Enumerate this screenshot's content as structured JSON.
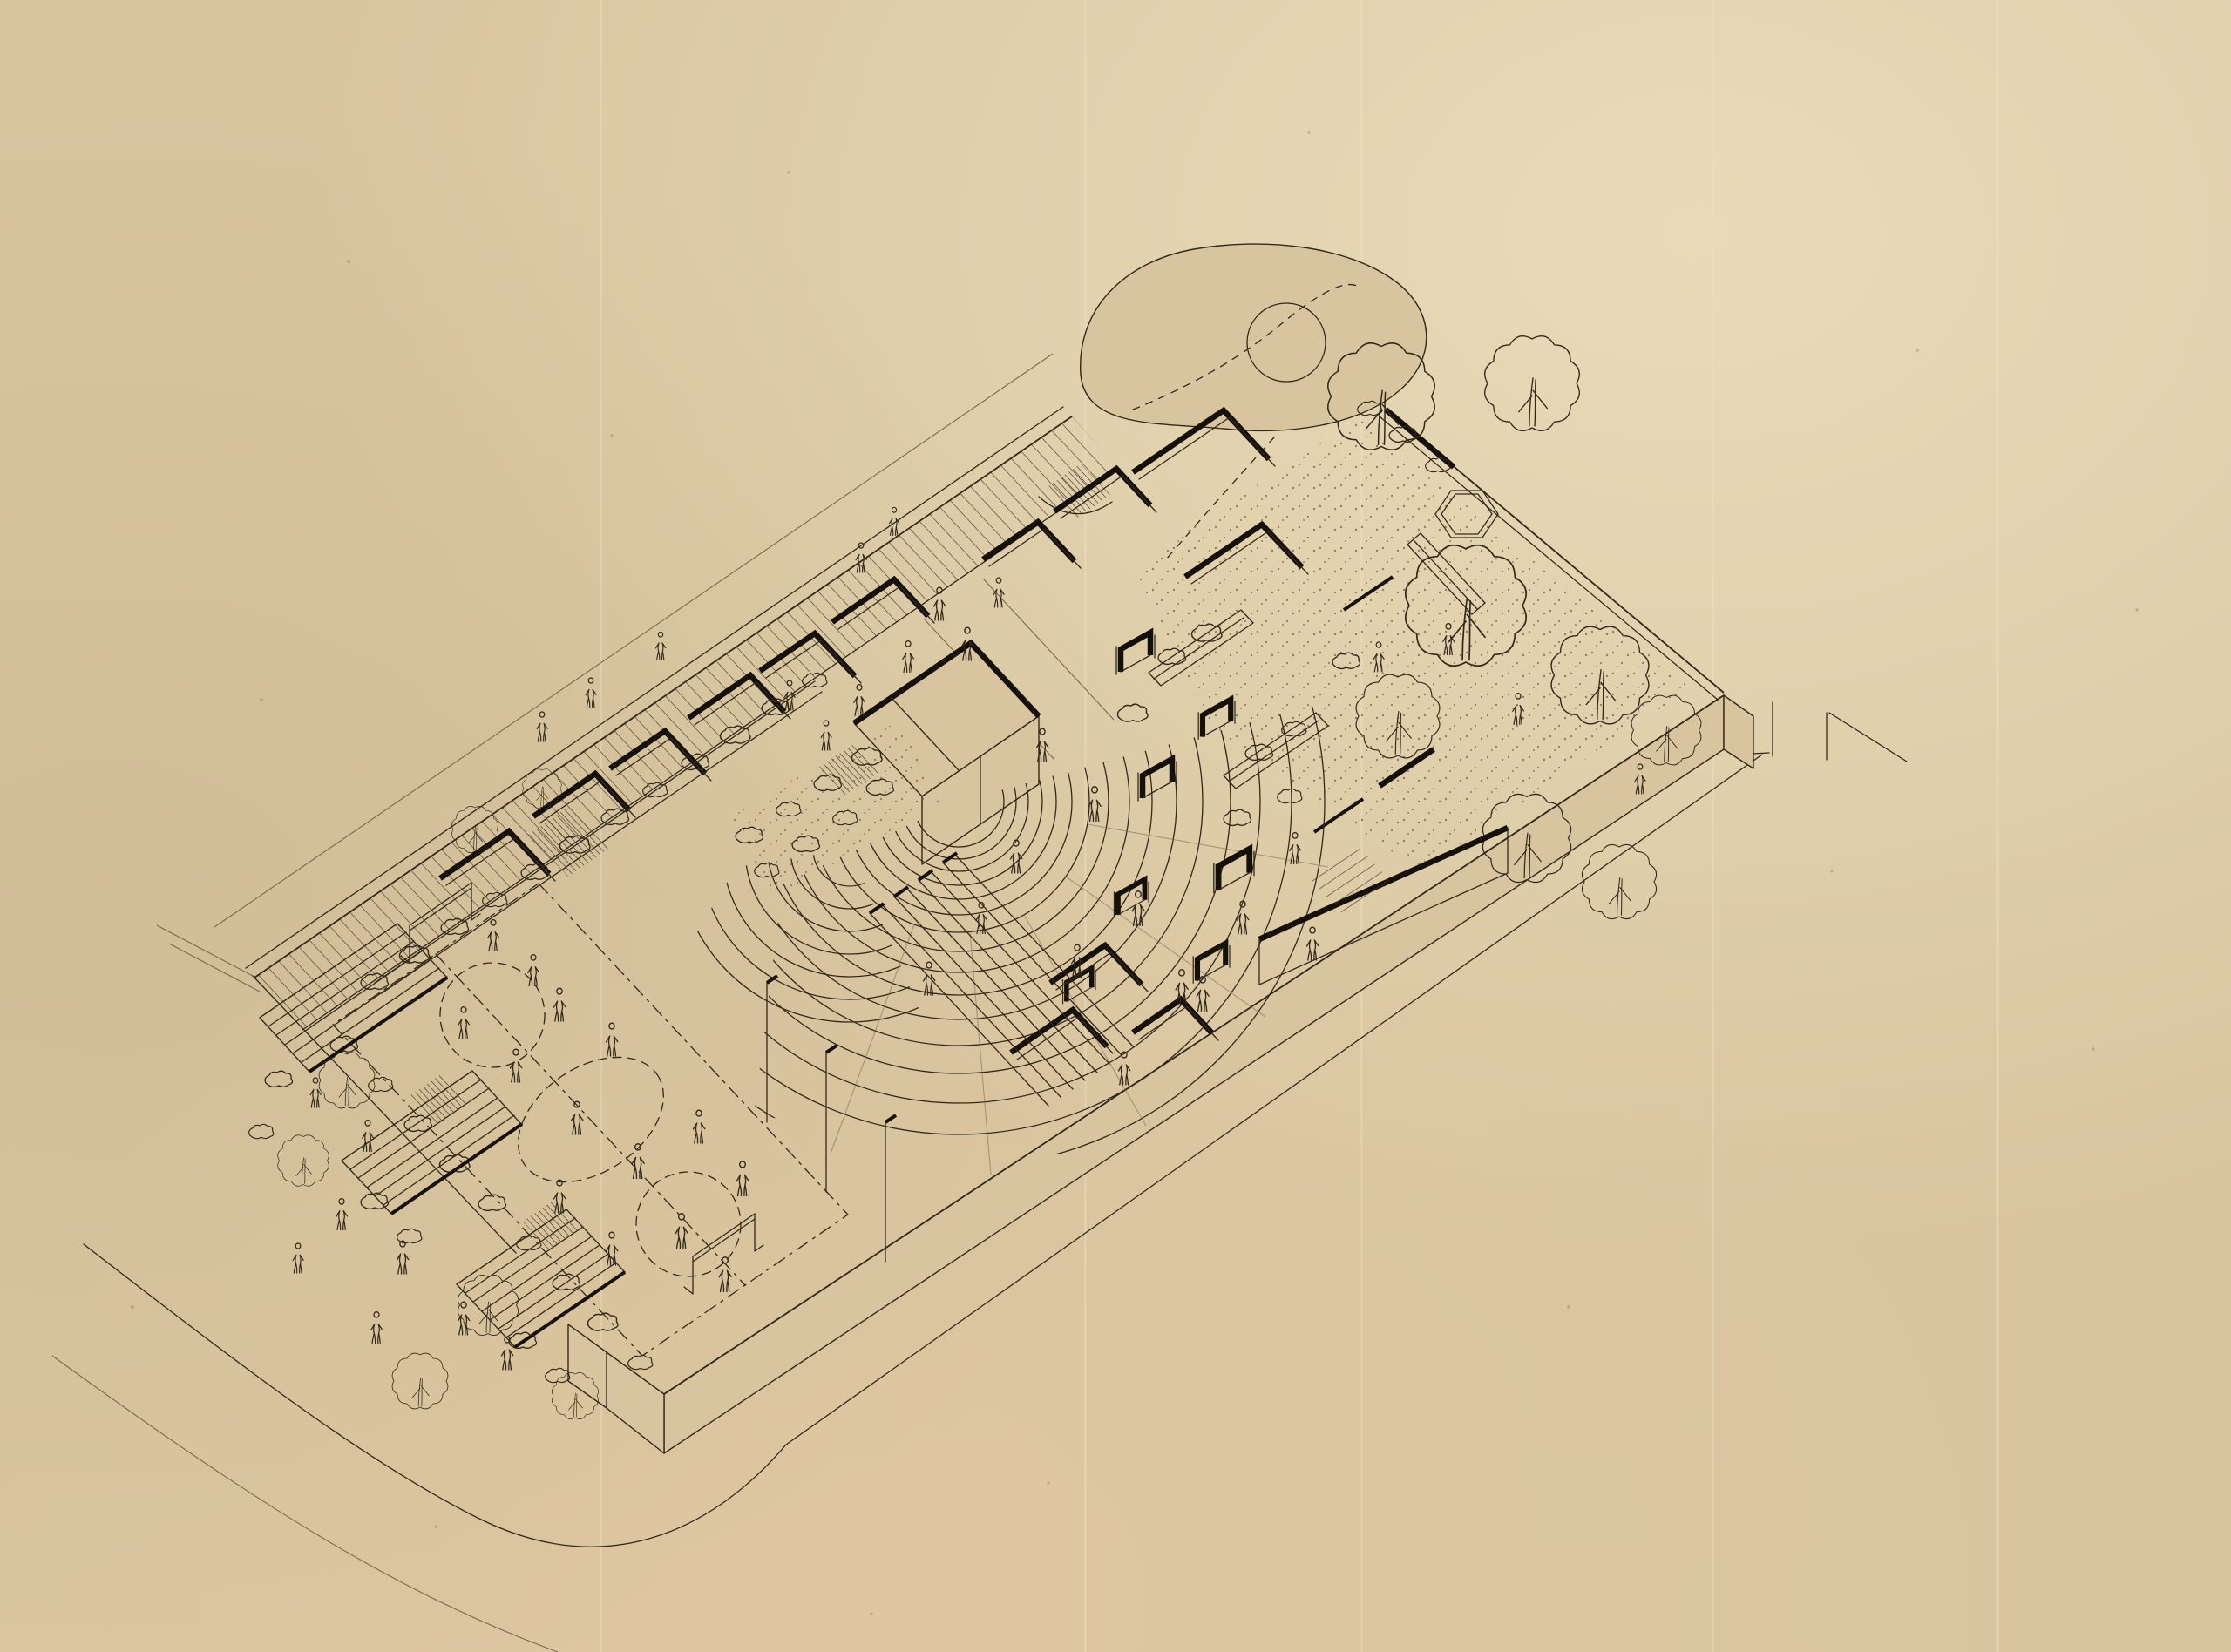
{
  "artwork": {
    "kind": "hand-drawn axonometric ink site plan of an urban playground park on aged tracing paper",
    "visible_text": "",
    "paper": {
      "base": "#d8c5a0",
      "light": "#ecdfbd",
      "warm": "#e0c8a2",
      "shade": "#c9b78f"
    },
    "ink": {
      "line": "#33291b",
      "bold": "#16100a",
      "faint": "#7a6a4e"
    },
    "scene_features": [
      "rounded street curb wrapping the site",
      "raised plinth with beveled corners",
      "perimeter sidewalk and hatched embankment along the long edge",
      "maze of freestanding play walls with heavy black caps",
      "raised stage deck with stair ramp",
      "fan of concentric amphitheater steps filled with people",
      "U-shaped concrete play sculptures",
      "garden terrace with large scalloped trees, planters, stippled ground and hexagonal sand pit",
      "organic mound path with circular planting ring",
      "ball court with dash-dot markings, goal frames and light poles",
      "long ramp walls beside the court",
      "stepped bleacher terraces with trees along the lower street corner",
      "dozens of small outlined pedestrian figures"
    ]
  }
}
